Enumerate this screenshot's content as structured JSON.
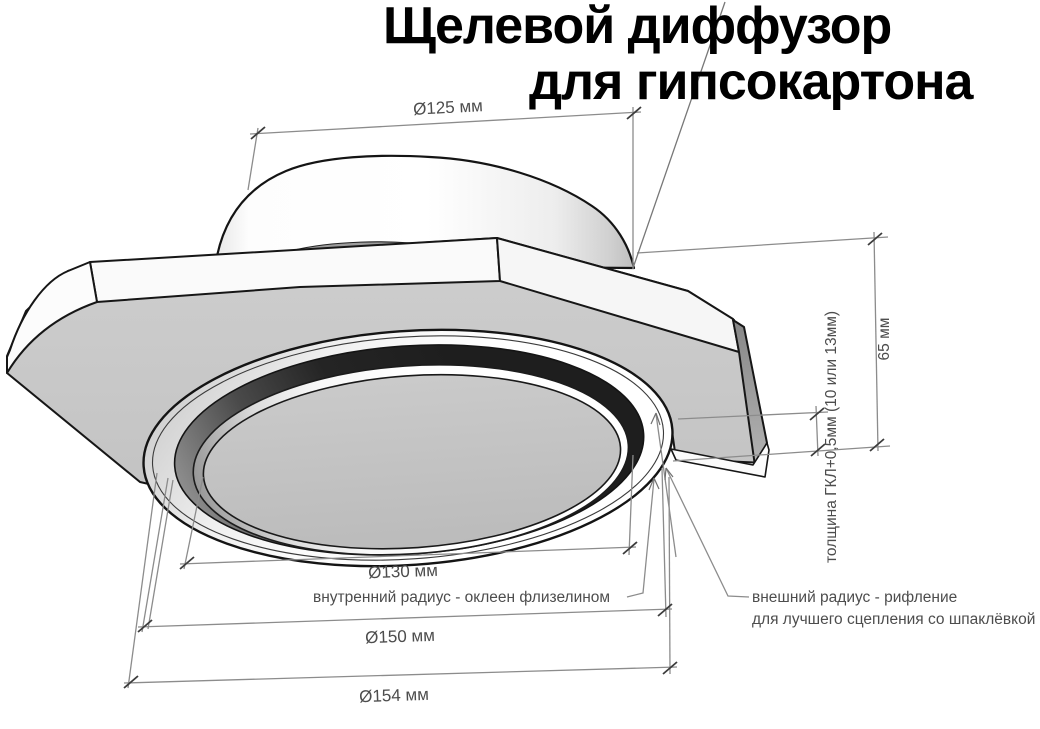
{
  "title": {
    "line1": "Щелевой диффузор",
    "line2": "для гипсокартона"
  },
  "dimensions": {
    "collar_diameter": "Ø125 мм",
    "height": "65 мм",
    "board_thickness": "толщина ГКЛ+0,5мм (10 или 13мм)",
    "inner_diameter": "Ø130 мм",
    "flange_diameter": "Ø150 мм",
    "outer_diameter": "Ø154 мм"
  },
  "annotations": {
    "inner_radius": "внутренний радиус - оклеен флизелином",
    "outer_radius_line1": "внешний радиус - рифление",
    "outer_radius_line2": "для лучшего сцепления со шпаклёвкой"
  },
  "colors": {
    "background": "#ffffff",
    "plate_gray": "#c8c8c8",
    "disc_gray": "#c2c2c2",
    "bevel_gray": "#949494",
    "slot_dark": "#222222",
    "edge_black": "#161616",
    "dimension_line_gray": "#8c8c8c",
    "tick_dark": "#3c3c3c",
    "label_gray": "#4d4d4d",
    "title_black": "#000000"
  }
}
